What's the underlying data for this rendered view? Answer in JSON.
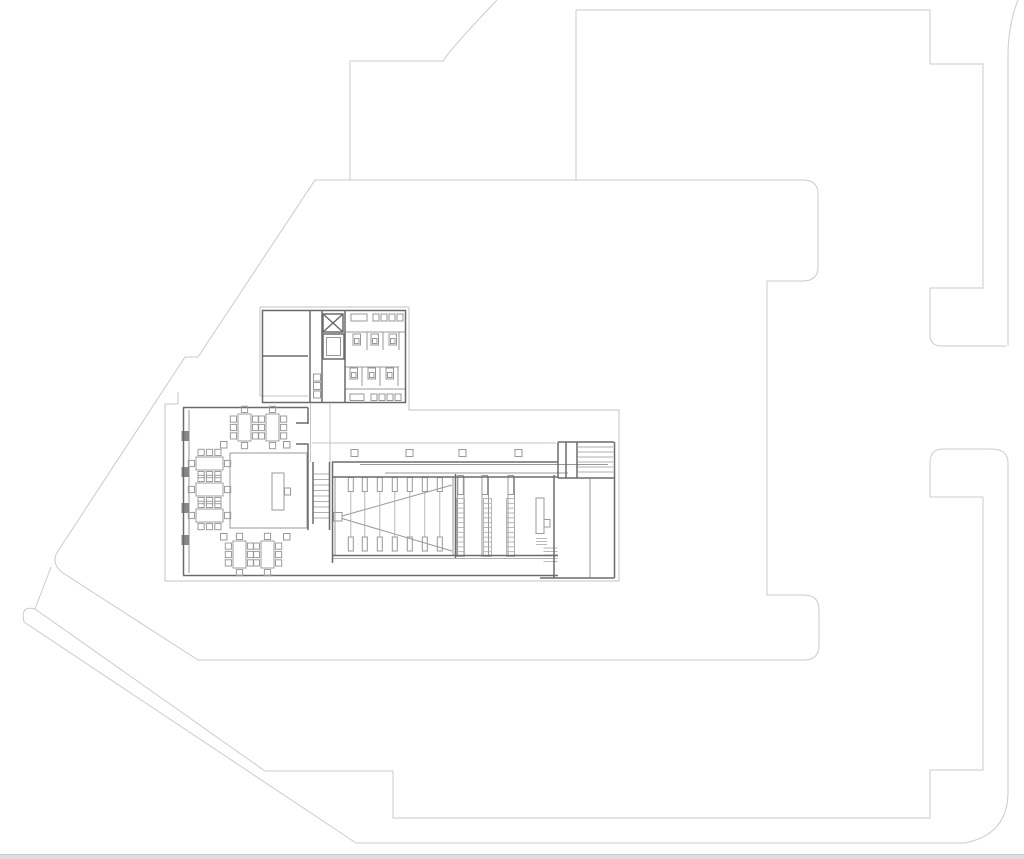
{
  "meta": {
    "description": "architectural-floor-plan",
    "view": "plan-drawing",
    "canvas": {
      "width": 1024,
      "height": 859,
      "background": "#ffffff"
    }
  },
  "palette": {
    "site_outline": "#c9cbcc",
    "platform_outline": "#c2c4c6",
    "wall": "#696b6d",
    "detail_medium": "#96989b",
    "detail_light": "#aeb0b2",
    "furniture": "#9b9da0",
    "mullion_fill": "#85878a",
    "scrollbar_track": "#dbdfe2",
    "scrollbar_border": "#c6cbcf"
  },
  "scrollbar": {
    "height": 5
  },
  "drawing": {
    "viewbox": "0 0 1024 854",
    "layers": [
      {
        "name": "site-boundary",
        "stroke": "#c9cbcc",
        "width": 1,
        "items": [
          {
            "t": "p",
            "d": "M497,0 Q452,47 443,61 H350 V180"
          },
          {
            "t": "p",
            "d": "M315,180 H803 Q818,180 818,194 V267 Q818,281 803,281 H767 V595 H804 Q819,595 819,610 V645 Q819,660 804,660 H198 L63,573 Q50,563 58,551 L185,357 H198 Z"
          },
          {
            "t": "p",
            "d": "M51,567 L35,609"
          },
          {
            "t": "p",
            "d": "M35,609 Q20,605 24,622"
          },
          {
            "t": "p",
            "d": "M35,609 L265,771"
          },
          {
            "t": "p",
            "d": "M24,622 L356,843"
          },
          {
            "t": "p",
            "d": "M265,771 H393 V818 H930 V770 H983 V497 H930 V463"
          },
          {
            "t": "p",
            "d": "M930,463 Q930,449 943,449 H991 Q1008,449 1008,463 V792 Q1008,835 964,843 H356"
          },
          {
            "t": "p",
            "d": "M576,10 V180"
          },
          {
            "t": "p",
            "d": "M576,10 H930 V64 H983 V288 H930 V335 Q930,346 942,346 H1006"
          },
          {
            "t": "p",
            "d": "M1018,0 Q1009,22 1008,52 V346"
          }
        ]
      },
      {
        "name": "building-platform",
        "stroke": "#c2c4c6",
        "width": 1,
        "items": [
          {
            "t": "p",
            "d": "M260,307 V396 M260,396 H308 M260,307 H409 M409,307 V410 H619 V581 M165,581 H619 M165,404 V581 M165,404 H178 M178,392 V404 M312,443 H556 M310.5,404 V462 M330,404 V462"
          }
        ]
      },
      {
        "name": "interior-detail-medium",
        "stroke": "#96989b",
        "width": 1,
        "items": [
          {
            "t": "p",
            "d": "M189,410 V573"
          },
          {
            "t": "p",
            "d": "M360,464.5 H608 M385,473 H568"
          },
          {
            "t": "p",
            "d": "M453,477 V556 M335,477 V556"
          },
          {
            "t": "vl",
            "xs": [
              457.5,
              464,
              482,
              488.5,
              508,
              514.5
            ],
            "y1": 477,
            "y2": 557
          },
          {
            "t": "p",
            "d": "M590,478 V578"
          },
          {
            "t": "r",
            "x": 230,
            "y": 453,
            "w": 77,
            "h": 75
          },
          {
            "t": "r",
            "x": 272,
            "y": 473,
            "w": 12,
            "h": 37
          },
          {
            "t": "r",
            "x": 284.5,
            "y": 488,
            "w": 6,
            "h": 7
          },
          {
            "t": "r",
            "x": 536,
            "y": 498,
            "w": 8,
            "h": 35.5
          },
          {
            "t": "r",
            "x": 544,
            "y": 519.5,
            "w": 6,
            "h": 7.5
          },
          {
            "t": "r",
            "x": 333.5,
            "y": 512.5,
            "w": 8.5,
            "h": 8.5
          },
          {
            "t": "p",
            "d": "M342,516 L452,485 M342,518.5 L452,551"
          },
          {
            "t": "nrv",
            "x": 313.5,
            "ys": [
              374,
              382.5,
              391
            ],
            "w": 7,
            "h": 7
          },
          {
            "t": "r",
            "x": 351,
            "y": 314,
            "w": 16,
            "h": 7
          },
          {
            "t": "nr",
            "xs": [
              373,
              381,
              389,
              397
            ],
            "y": 314,
            "w": 6,
            "h": 7
          },
          {
            "t": "p",
            "d": "M345,332 H405 M345,367 H399 M345,389 H405"
          },
          {
            "t": "p",
            "d": "M367,332 V350 M383,332 V350 M399,332 V350 M362,367 V386 M380,367 V386 M398,367 V386"
          },
          {
            "t": "r",
            "x": 350,
            "y": 394,
            "w": 14,
            "h": 6.5
          },
          {
            "t": "nr",
            "xs": [
              371,
              379,
              387,
              395
            ],
            "y": 394,
            "w": 6,
            "h": 6.5
          },
          {
            "t": "wc",
            "x": 353,
            "y": 334
          },
          {
            "t": "wc",
            "x": 371,
            "y": 334
          },
          {
            "t": "wc",
            "x": 389,
            "y": 334
          },
          {
            "t": "wc",
            "x": 350,
            "y": 368
          },
          {
            "t": "wc",
            "x": 368,
            "y": 368
          },
          {
            "t": "wc",
            "x": 386,
            "y": 368
          },
          {
            "t": "r",
            "x": 326.5,
            "y": 337.5,
            "w": 14,
            "h": 18
          },
          {
            "t": "nr",
            "xs": [
              351,
              406,
              459,
              515
            ],
            "y": 449.5,
            "w": 7,
            "h": 7
          },
          {
            "t": "nr",
            "xs": [
              220.5,
              283.5
            ],
            "y": 441.5,
            "w": 6.5,
            "h": 6.5
          },
          {
            "t": "nr",
            "xs": [
              220.5,
              283.5
            ],
            "y": 533.5,
            "w": 6.5,
            "h": 6.5
          },
          {
            "t": "nr",
            "xs": [
              348.3,
              362.3,
              377.3,
              392.3,
              407.3,
              422.3,
              437.3
            ],
            "y": 477.5,
            "w": 5,
            "h": 14
          },
          {
            "t": "nr",
            "xs": [
              348.3,
              362.3,
              377.3,
              392.3,
              407.3,
              422.3,
              437.3
            ],
            "y": 537,
            "w": 5,
            "h": 14
          },
          {
            "t": "nr",
            "xs": [
              457.8,
              482,
              508
            ],
            "y": 475.5,
            "w": 5.5,
            "h": 19
          },
          {
            "t": "nrv",
            "x": 181.5,
            "ys": [
              431,
              467,
              503,
              535
            ],
            "w": 8,
            "h": 10,
            "fill": "#85878a"
          }
        ]
      },
      {
        "name": "steps-and-seating",
        "stroke": "#aeb0b2",
        "width": 0.9,
        "items": [
          {
            "t": "vl",
            "xs": [
              350.8,
              364.8,
              379.8,
              394.8,
              409.8,
              424.8,
              439.8
            ],
            "y1": 491,
            "y2": 537
          },
          {
            "t": "hl",
            "ys": [
              474,
              479.5,
              485,
              490.5,
              496,
              501.5,
              507,
              512.5,
              518
            ],
            "x1": 313,
            "x2": 329.5
          },
          {
            "t": "hl",
            "ys": [
              447,
              452,
              457,
              462,
              467,
              472
            ],
            "x1": 578,
            "x2": 613
          },
          {
            "t": "hl",
            "ys": [
              548,
              551.5,
              555,
              558.5,
              561.5
            ],
            "x1": 543.5,
            "x2": 557.5
          },
          {
            "t": "hl",
            "ys": [
              538.5,
              541.5,
              544.5
            ],
            "x1": 536,
            "x2": 547
          },
          {
            "t": "ladder",
            "x": 456.5,
            "y": 498.5,
            "w": 8,
            "h": 58,
            "n": 12
          },
          {
            "t": "ladder",
            "x": 483.5,
            "y": 498.5,
            "w": 8,
            "h": 58,
            "n": 12
          },
          {
            "t": "ladder",
            "x": 506.5,
            "y": 498.5,
            "w": 8,
            "h": 58,
            "n": 12
          },
          {
            "t": "p",
            "d": "M332,558.5 H554"
          }
        ]
      },
      {
        "name": "walls",
        "stroke": "#696b6d",
        "width": 1.5,
        "items": [
          {
            "t": "p",
            "d": "M262.5,310.5 H405.5 V402.5 H262.5 Z"
          },
          {
            "t": "p",
            "d": "M322,310.5 V402.5 M345,310.5 V402.5 M262.5,356 H308 M310,310.5 V402.5"
          },
          {
            "t": "p",
            "d": "M183,407.5 H308 M183.5,407.5 V575 M183,575.5 H558"
          },
          {
            "t": "p",
            "d": "M308,407.5 V424 M308,443.5 V530 M296,423 H308 M296,444 H308"
          },
          {
            "t": "p",
            "d": "M313,462 V524 M329.5,462 V530"
          },
          {
            "t": "p",
            "d": "M332,462 H558 M332.5,462 V563 M332,477 H558"
          },
          {
            "t": "p",
            "d": "M455.5,474 V558 M332,555.5 H558 M554,475 V578"
          },
          {
            "t": "p",
            "d": "M558,442 H614 M558,442 V478 M566,442 V478 M577,442 V478 M614.5,442 V578 M558,478 H614 M540,578 H614.5"
          },
          {
            "t": "xbox",
            "x": 323,
            "y": 314,
            "w": 20,
            "h": 18
          },
          {
            "t": "r",
            "x": 323,
            "y": 334,
            "w": 21,
            "h": 25
          }
        ]
      },
      {
        "name": "furniture-tables",
        "stroke": "#9b9da0",
        "width": 1,
        "items": [
          {
            "t": "table",
            "x": 238,
            "y": 414,
            "o": "v"
          },
          {
            "t": "table",
            "x": 266,
            "y": 414,
            "o": "v"
          },
          {
            "t": "table",
            "x": 233,
            "y": 541,
            "o": "v"
          },
          {
            "t": "table",
            "x": 261,
            "y": 541,
            "o": "v"
          },
          {
            "t": "table",
            "x": 196,
            "y": 457,
            "o": "h"
          },
          {
            "t": "table",
            "x": 196,
            "y": 483,
            "o": "h"
          },
          {
            "t": "table",
            "x": 196,
            "y": 509,
            "o": "h"
          }
        ]
      }
    ]
  }
}
